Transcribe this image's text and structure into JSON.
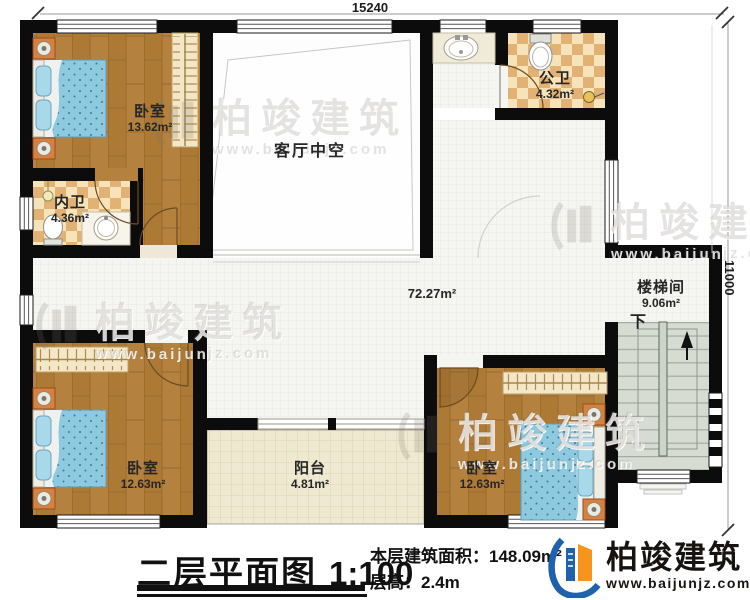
{
  "dims": {
    "top": "15240",
    "right": "11000"
  },
  "rooms": {
    "bedroom1": {
      "name": "卧室",
      "area": "13.62m²"
    },
    "innerBath": {
      "name": "内卫",
      "area": "4.36m²"
    },
    "livingVoid": {
      "name": "客厅中空"
    },
    "publicBath": {
      "name": "公卫",
      "area": "4.32m²"
    },
    "hallway": {
      "area": "72.27m²"
    },
    "stairwell": {
      "name": "楼梯间",
      "area": "9.06m²",
      "down": "下"
    },
    "balcony": {
      "name": "阳台",
      "area": "4.81m²"
    },
    "bedroom2": {
      "name": "卧室",
      "area": "12.63m²"
    },
    "bedroom3": {
      "name": "卧室",
      "area": "12.63m²"
    }
  },
  "titleblock": {
    "title": "二层平面图",
    "scale": "1:100",
    "area_label": "本层建筑面积：",
    "area_value": "148.09m²",
    "height_label": "层高：",
    "height_value": "2.4m"
  },
  "logo": {
    "brand": "柏竣建筑",
    "url": "www.baijunjz.com"
  },
  "watermark": {
    "brand": "柏竣建筑",
    "url": "www.baijunjz.com"
  },
  "colors": {
    "wall": "#0c0c0c",
    "wood_floor": "#b5813f",
    "bath_checker_light": "#f6e3ba",
    "bath_checker_dark": "#e2b274",
    "hall_tile": "#f5f5f2",
    "balcony_tile": "#efe9d1",
    "stair_floor": "#d6dcd2",
    "bed_blue": "#8ecadf",
    "nightstand_orange": "#d9803f",
    "logo_blue": "#1e62ad",
    "logo_orange": "#f7941d"
  }
}
